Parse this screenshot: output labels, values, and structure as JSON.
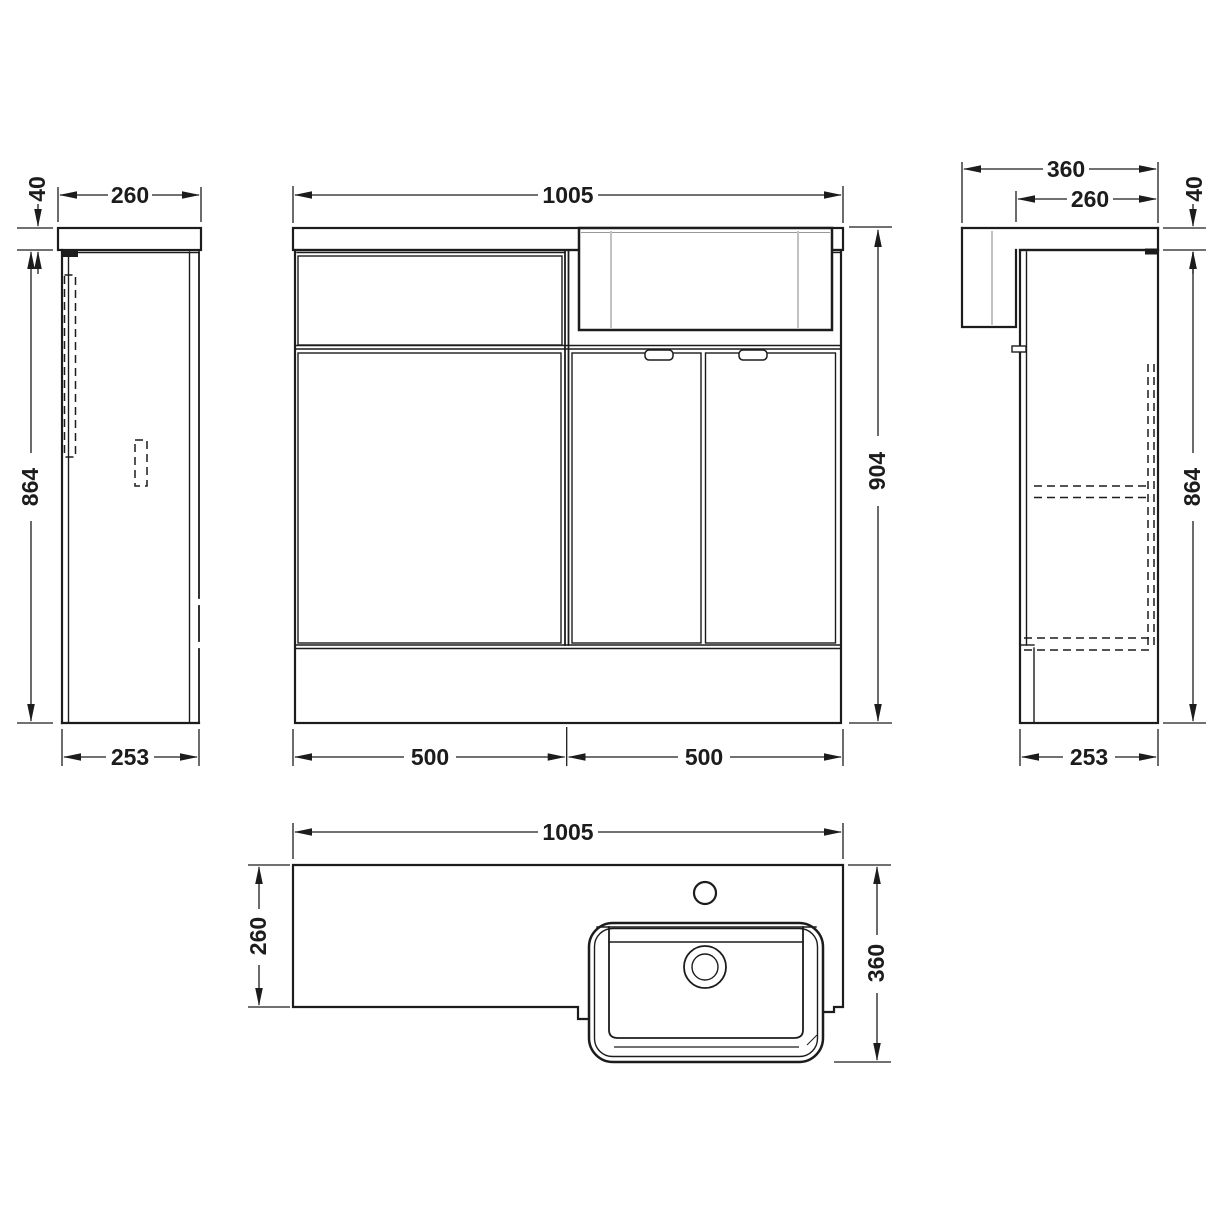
{
  "colors": {
    "background": "#ffffff",
    "line": "#1c1c1c",
    "light_line": "#c2c2c2"
  },
  "views": {
    "side_left": {
      "dim_worktop_thickness": "40",
      "dim_worktop_depth": "260",
      "dim_cabinet_height": "864",
      "dim_cabinet_depth": "253"
    },
    "front": {
      "dim_overall_width": "1005",
      "dim_overall_height": "904",
      "dim_left_unit_width": "500",
      "dim_right_unit_width": "500"
    },
    "side_right": {
      "dim_overall_depth": "360",
      "dim_worktop_depth": "260",
      "dim_worktop_thickness": "40",
      "dim_cabinet_height": "864",
      "dim_cabinet_depth": "253"
    },
    "plan": {
      "dim_overall_width": "1005",
      "dim_worktop_depth": "260",
      "dim_overall_depth": "360"
    }
  }
}
